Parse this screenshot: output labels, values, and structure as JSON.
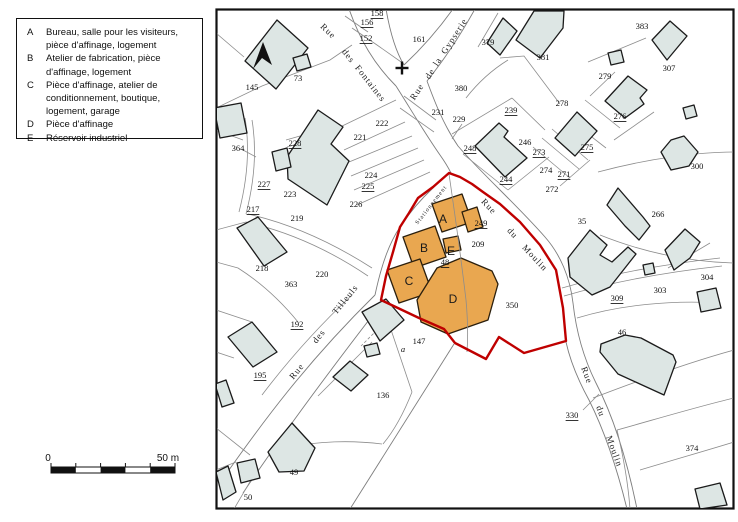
{
  "legend": {
    "items": [
      {
        "key": "A",
        "label": "Bureau, salle pour les visiteurs, pièce d'affinage, logement"
      },
      {
        "key": "B",
        "label": "Atelier de fabrication, pièce d'affinage, logement"
      },
      {
        "key": "C",
        "label": "Pièce d'affinage, atelier de conditionnement, boutique, logement, garage"
      },
      {
        "key": "D",
        "label": "Pièce d'affinage"
      },
      {
        "key": "E",
        "label": "Réservoir industriel"
      }
    ]
  },
  "scale_bar": {
    "start_label": "0",
    "end_label": "50 m"
  },
  "map": {
    "colors": {
      "building_fill": "#dde6e4",
      "building_stroke": "#1b1b1b",
      "highlight_fill": "#e9a750",
      "highlight_stroke": "#2b1f0d",
      "boundary_red": "#bf0000",
      "parcel_line": "#8c8c8c",
      "frame": "#111111"
    },
    "icons": {
      "north_arrow": "north-arrow-icon",
      "cross": "cross-icon"
    },
    "building_labels": [
      {
        "text": "A",
        "x": 443,
        "y": 219
      },
      {
        "text": "B",
        "x": 424,
        "y": 248
      },
      {
        "text": "C",
        "x": 409,
        "y": 281
      },
      {
        "text": "D",
        "x": 453,
        "y": 299
      },
      {
        "text": "E",
        "x": 451,
        "y": 251
      }
    ],
    "street_labels": [
      {
        "text": "Rue",
        "x": 322,
        "y": 25,
        "rotate": 44
      },
      {
        "text": "des",
        "x": 344,
        "y": 50,
        "rotate": 52
      },
      {
        "text": "Fontaines",
        "x": 357,
        "y": 66,
        "rotate": 52
      },
      {
        "text": "Rue",
        "x": 412,
        "y": 99,
        "rotate": -57
      },
      {
        "text": "de",
        "x": 427,
        "y": 78,
        "rotate": -57
      },
      {
        "text": "la",
        "x": 435,
        "y": 65,
        "rotate": -57
      },
      {
        "text": "Gypserie",
        "x": 443,
        "y": 53,
        "rotate": -57
      },
      {
        "text": "Rue",
        "x": 483,
        "y": 200,
        "rotate": 47
      },
      {
        "text": "du",
        "x": 509,
        "y": 229,
        "rotate": 47
      },
      {
        "text": "Moulin",
        "x": 524,
        "y": 246,
        "rotate": 47
      },
      {
        "text": "Rue",
        "x": 584,
        "y": 367,
        "rotate": 70
      },
      {
        "text": "du",
        "x": 599,
        "y": 406,
        "rotate": 70
      },
      {
        "text": "Moulin",
        "x": 609,
        "y": 436,
        "rotate": 70
      },
      {
        "text": "Rue",
        "x": 291,
        "y": 378,
        "rotate": -51
      },
      {
        "text": "des",
        "x": 314,
        "y": 342,
        "rotate": -51
      },
      {
        "text": "Tilleuls",
        "x": 334,
        "y": 313,
        "rotate": -51
      },
      {
        "text": "Stationnement",
        "x": 417,
        "y": 224,
        "rotate": -52,
        "size": 6
      }
    ],
    "parcel_labels": [
      {
        "text": "158",
        "x": 377,
        "y": 13,
        "underline": true
      },
      {
        "text": "156",
        "x": 367,
        "y": 22,
        "underline": true
      },
      {
        "text": "152",
        "x": 366,
        "y": 38,
        "underline": true
      },
      {
        "text": "161",
        "x": 419,
        "y": 39
      },
      {
        "text": "379",
        "x": 488,
        "y": 42
      },
      {
        "text": "383",
        "x": 642,
        "y": 26
      },
      {
        "text": "381",
        "x": 543,
        "y": 57
      },
      {
        "text": "307",
        "x": 669,
        "y": 68
      },
      {
        "text": "380",
        "x": 461,
        "y": 88
      },
      {
        "text": "231",
        "x": 438,
        "y": 112
      },
      {
        "text": "229",
        "x": 459,
        "y": 119
      },
      {
        "text": "239",
        "x": 511,
        "y": 110,
        "underline": true
      },
      {
        "text": "278",
        "x": 562,
        "y": 103
      },
      {
        "text": "279",
        "x": 605,
        "y": 76
      },
      {
        "text": "276",
        "x": 620,
        "y": 116,
        "underline": true
      },
      {
        "text": "248",
        "x": 470,
        "y": 148,
        "underline": true
      },
      {
        "text": "246",
        "x": 525,
        "y": 142
      },
      {
        "text": "273",
        "x": 539,
        "y": 152,
        "underline": true
      },
      {
        "text": "275",
        "x": 587,
        "y": 147,
        "underline": true
      },
      {
        "text": "274",
        "x": 546,
        "y": 170
      },
      {
        "text": "271",
        "x": 564,
        "y": 174,
        "underline": true
      },
      {
        "text": "272",
        "x": 552,
        "y": 189
      },
      {
        "text": "244",
        "x": 506,
        "y": 179,
        "underline": true
      },
      {
        "text": "300",
        "x": 697,
        "y": 166
      },
      {
        "text": "266",
        "x": 658,
        "y": 214
      },
      {
        "text": "35",
        "x": 582,
        "y": 221
      },
      {
        "text": "304",
        "x": 707,
        "y": 277
      },
      {
        "text": "303",
        "x": 660,
        "y": 290
      },
      {
        "text": "309",
        "x": 617,
        "y": 298,
        "underline": true
      },
      {
        "text": "46",
        "x": 622,
        "y": 332
      },
      {
        "text": "330",
        "x": 572,
        "y": 415,
        "underline": true
      },
      {
        "text": "374",
        "x": 692,
        "y": 448
      },
      {
        "text": "249",
        "x": 481,
        "y": 223,
        "underline": true
      },
      {
        "text": "209",
        "x": 478,
        "y": 244
      },
      {
        "text": "48",
        "x": 445,
        "y": 262,
        "underline": true
      },
      {
        "text": "350",
        "x": 512,
        "y": 305
      },
      {
        "text": "73",
        "x": 298,
        "y": 78
      },
      {
        "text": "145",
        "x": 252,
        "y": 87
      },
      {
        "text": "364",
        "x": 238,
        "y": 148
      },
      {
        "text": "222",
        "x": 382,
        "y": 123
      },
      {
        "text": "221",
        "x": 360,
        "y": 137
      },
      {
        "text": "228",
        "x": 295,
        "y": 143,
        "underline": true
      },
      {
        "text": "227",
        "x": 264,
        "y": 184,
        "underline": true
      },
      {
        "text": "223",
        "x": 290,
        "y": 194
      },
      {
        "text": "224",
        "x": 371,
        "y": 175
      },
      {
        "text": "225",
        "x": 368,
        "y": 186,
        "underline": true
      },
      {
        "text": "226",
        "x": 356,
        "y": 204
      },
      {
        "text": "217",
        "x": 253,
        "y": 209,
        "underline": true
      },
      {
        "text": "219",
        "x": 297,
        "y": 218
      },
      {
        "text": "218",
        "x": 262,
        "y": 268
      },
      {
        "text": "220",
        "x": 322,
        "y": 274
      },
      {
        "text": "363",
        "x": 291,
        "y": 284
      },
      {
        "text": "192",
        "x": 297,
        "y": 324,
        "underline": true
      },
      {
        "text": "195",
        "x": 260,
        "y": 375,
        "underline": true
      },
      {
        "text": "147",
        "x": 419,
        "y": 341
      },
      {
        "text": "a",
        "x": 403,
        "y": 349,
        "italic": true
      },
      {
        "text": "136",
        "x": 383,
        "y": 395
      },
      {
        "text": "49",
        "x": 294,
        "y": 472
      },
      {
        "text": "50",
        "x": 248,
        "y": 497
      }
    ]
  }
}
